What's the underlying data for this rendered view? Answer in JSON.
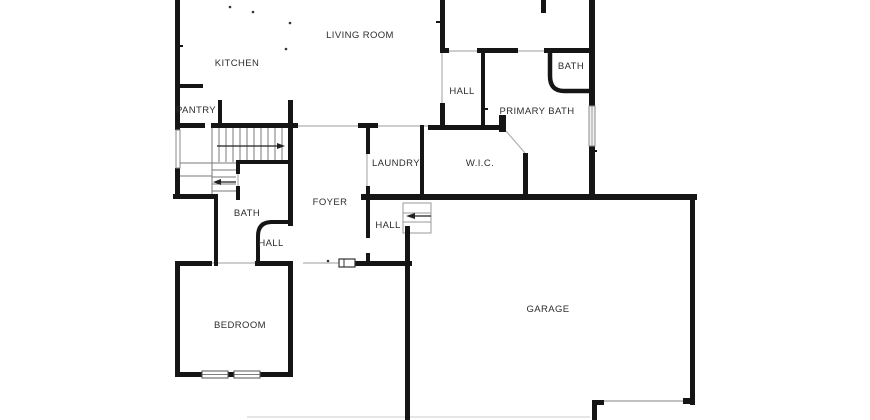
{
  "title": "residential-floor-plan",
  "colors": {
    "background": "#ffffff",
    "wall": "#151515",
    "opening_line": "#b0b0b0",
    "stair_line": "#7a7a7a",
    "label": "#2d2d2d"
  },
  "rooms": {
    "kitchen": "KITCHEN",
    "living_room": "LIVING ROOM",
    "pantry": "PANTRY",
    "hall_upper": "HALL",
    "bath_upper": "BATH",
    "primary_bath": "PRIMARY BATH",
    "laundry": "LAUNDRY",
    "wic": "W.I.C.",
    "foyer": "FOYER",
    "bath_lower": "BATH",
    "hall_lower": "HALL",
    "hall_entry": "HALL",
    "bedroom": "BEDROOM",
    "garage": "GARAGE"
  }
}
